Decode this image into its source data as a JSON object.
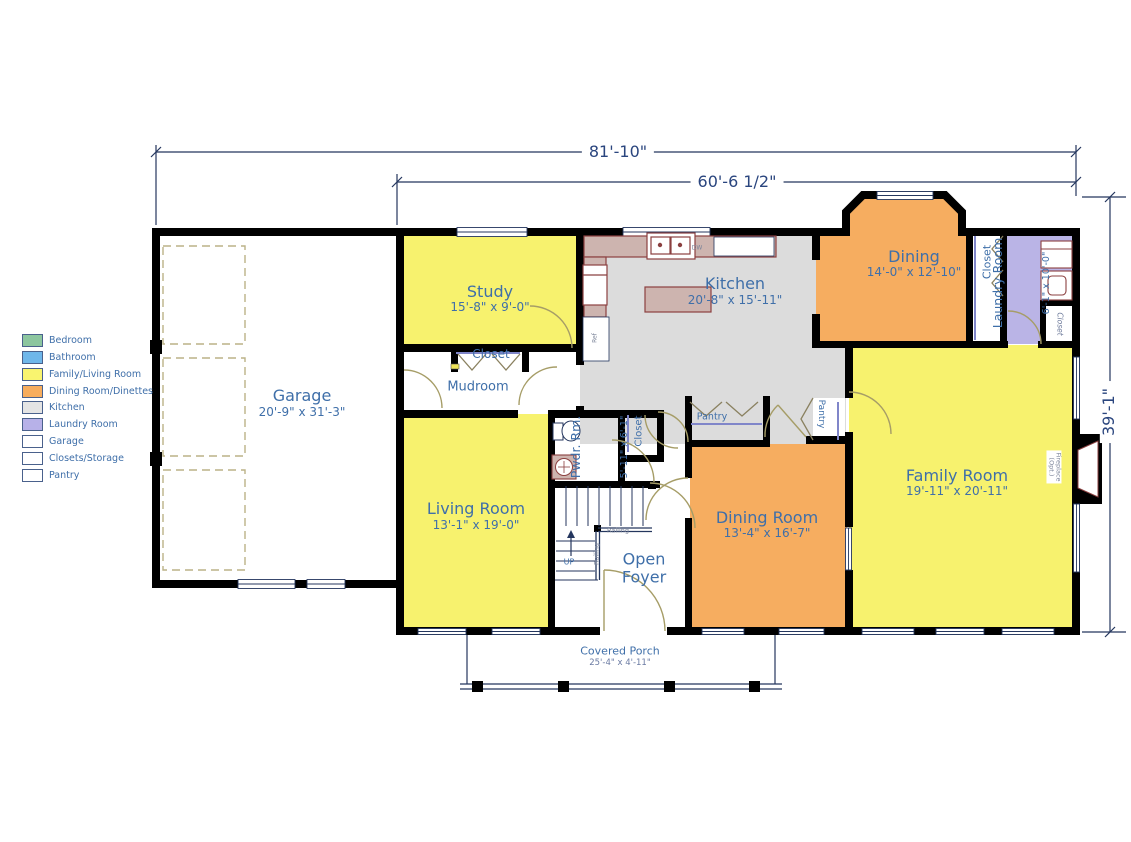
{
  "dimensions": {
    "overall_width": "81'-10\"",
    "main_width": "60'-6 1/2\"",
    "height": "39'-1\""
  },
  "rooms": {
    "garage": {
      "name": "Garage",
      "dims": "20'-9\" x 31'-3\""
    },
    "study": {
      "name": "Study",
      "dims": "15'-8\" x 9'-0\""
    },
    "kitchen": {
      "name": "Kitchen",
      "dims": "20'-8\" x 15'-11\""
    },
    "dining": {
      "name": "Dining",
      "dims": "14'-0\" x 12'-10\""
    },
    "laundry": {
      "name": "Laundry Room",
      "dims": "6'-1\" x 10'-0\""
    },
    "living": {
      "name": "Living Room",
      "dims": "13'-1\" x 19'-0\""
    },
    "dining_room": {
      "name": "Dining Room",
      "dims": "13'-4\" x 16'-7\""
    },
    "family": {
      "name": "Family Room",
      "dims": "19'-11\" x 20'-11\""
    },
    "powder": {
      "name": "Pwdr. Rm.",
      "dims": "5'-11\" x 6'-1\""
    },
    "foyer": {
      "name": "Open\nFoyer"
    },
    "mudroom": {
      "name": "Mudroom"
    },
    "porch": {
      "name": "Covered Porch",
      "dims": "25'-4\" x 4'-11\""
    }
  },
  "labels": {
    "closet": "Closet",
    "pantry": "Pantry",
    "railing": "Railing",
    "up": "UP",
    "dw": "DW",
    "ref": "Ref",
    "fireplace": "Fireplace\n(Opt.)"
  },
  "legend": {
    "items": [
      {
        "label": "Bedroom",
        "color": "#8cc69f"
      },
      {
        "label": "Bathroom",
        "color": "#6fb7ea"
      },
      {
        "label": "Family/Living Room",
        "color": "#f9f46f"
      },
      {
        "label": "Dining Room/Dinettes",
        "color": "#f7ad5d"
      },
      {
        "label": "Kitchen",
        "color": "#e4e4e4"
      },
      {
        "label": "Laundry Room",
        "color": "#b7b1e8"
      },
      {
        "label": "Garage",
        "color": "#ffffff"
      },
      {
        "label": "Closets/Storage",
        "color": "#ffffff"
      },
      {
        "label": "Pantry",
        "color": "#ffffff"
      }
    ]
  },
  "colors": {
    "family_living": "#f7f26e",
    "dining": "#f6ad60",
    "kitchen": "#dcdcdc",
    "laundry": "#bab4e6",
    "wall": "#000000",
    "room_label": "#3f6fa9",
    "dimension_text": "#2a457e"
  }
}
